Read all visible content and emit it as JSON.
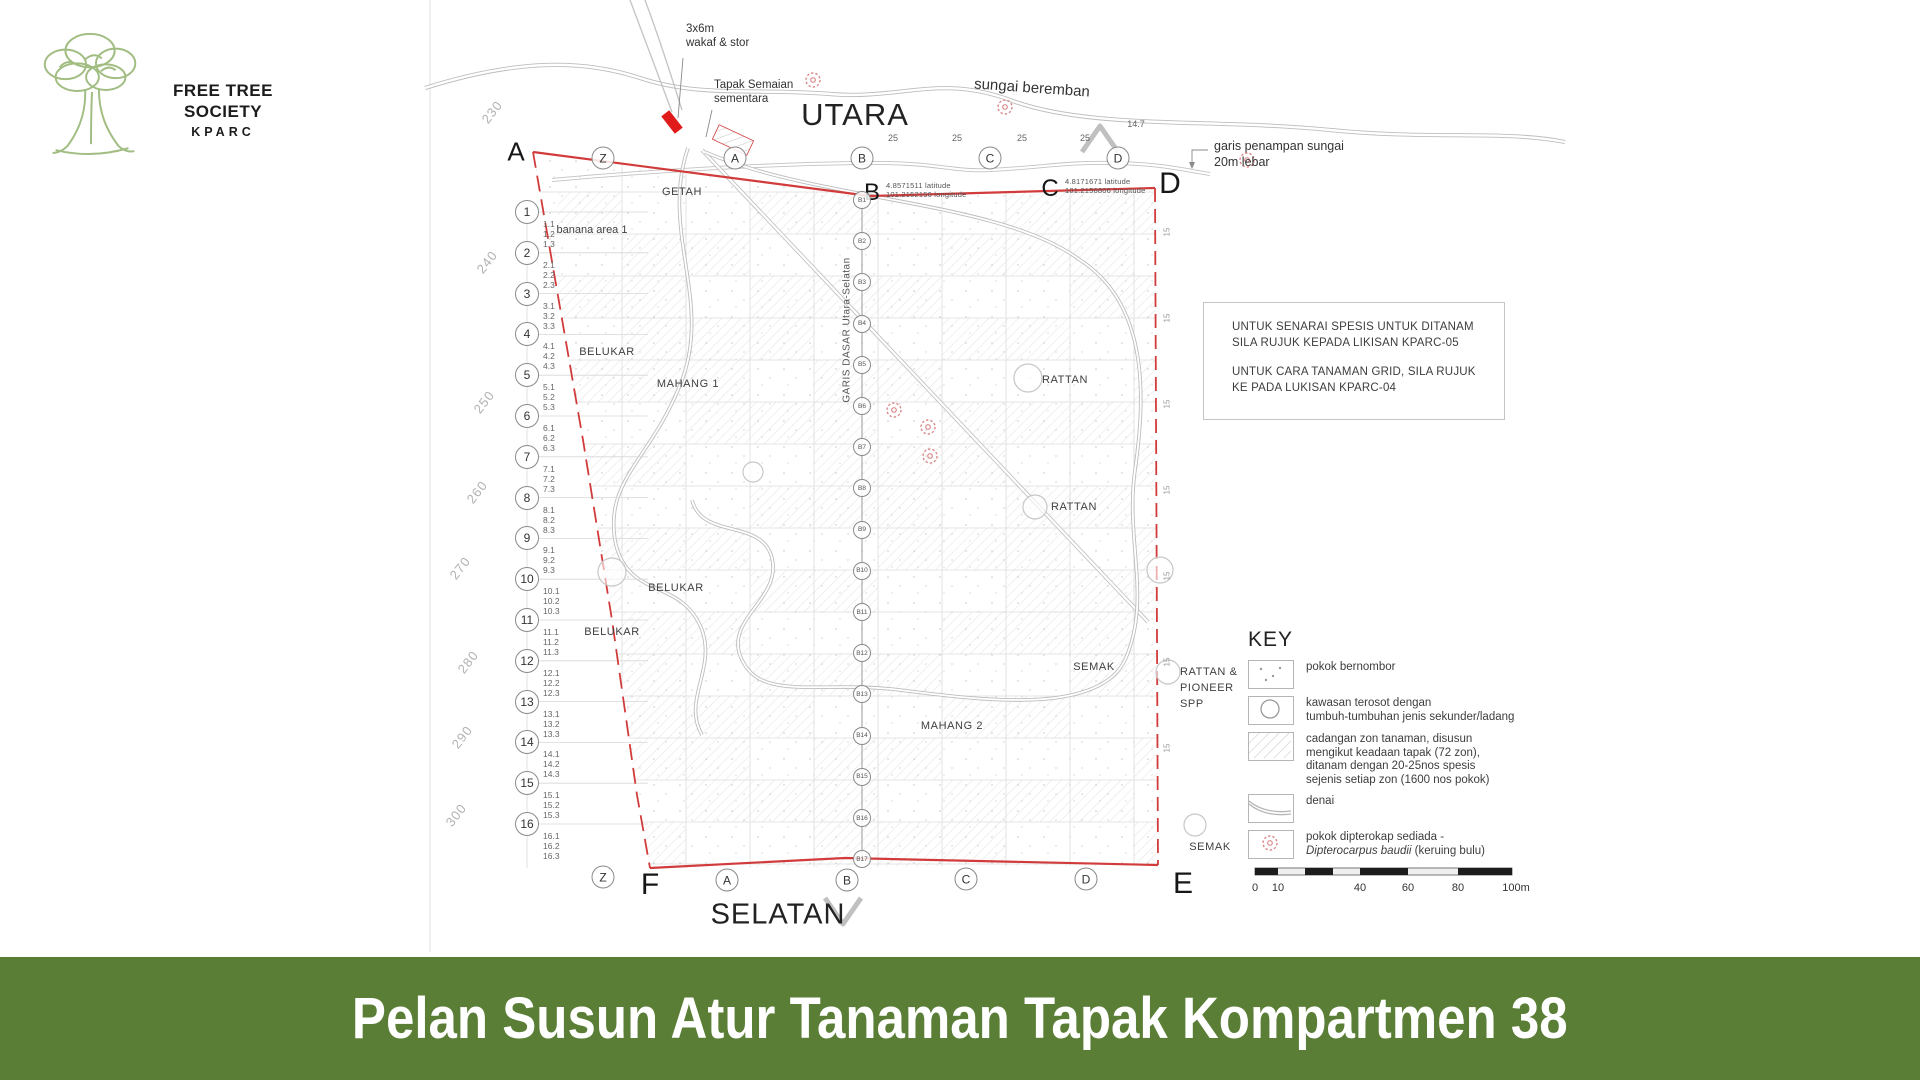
{
  "logo": {
    "org": [
      "FREE TREE",
      "SOCIETY"
    ],
    "site": "KPARC"
  },
  "colors": {
    "footer_green": "#5a7e36",
    "boundary_red": "#d23b3b",
    "logo_green": "#9cba7c",
    "wakaf_red": "#e01b1b"
  },
  "compass": {
    "north": "UTARA",
    "south": "SELATAN"
  },
  "river_label": "sungai beremban",
  "annotations": {
    "wakaf_line1": "3x6m",
    "wakaf_line2": "wakaf & stor",
    "semaian_line1": "Tapak Semaian",
    "semaian_line2": "sementara",
    "buffer_line1": "garis penampan sungai",
    "buffer_line2": "20m lebar"
  },
  "survey_points": {
    "B": {
      "letter": "B",
      "lat": "4.8571511  latitude",
      "lng": "101.2152156  longitude"
    },
    "C": {
      "letter": "C",
      "lat": "4.8171671  latitude",
      "lng": "101.2156806  longitude"
    }
  },
  "corner_letters": {
    "top_left": "A",
    "top_right": "D",
    "bottom_left": "F",
    "bottom_right": "E"
  },
  "grid_letters_top": [
    "Z",
    "A",
    "B",
    "C",
    "D"
  ],
  "grid_letters_bottom": [
    "Z",
    "A",
    "B",
    "C",
    "D"
  ],
  "top_distances": [
    "25",
    "25",
    "25",
    "25"
  ],
  "top_distance_end": "14.7",
  "right_tick_value": "15",
  "contour_labels": [
    "230",
    "240",
    "250",
    "260",
    "270",
    "280",
    "290",
    "300"
  ],
  "row_numbers": [
    {
      "n": "1",
      "subs": [
        "1.1",
        "1.2",
        "1.3"
      ]
    },
    {
      "n": "2",
      "subs": [
        "2.1",
        "2.2",
        "2.3"
      ]
    },
    {
      "n": "3",
      "subs": [
        "3.1",
        "3.2",
        "3.3"
      ]
    },
    {
      "n": "4",
      "subs": [
        "4.1",
        "4.2",
        "4.3"
      ]
    },
    {
      "n": "5",
      "subs": [
        "5.1",
        "5.2",
        "5.3"
      ]
    },
    {
      "n": "6",
      "subs": [
        "6.1",
        "6.2",
        "6.3"
      ]
    },
    {
      "n": "7",
      "subs": [
        "7.1",
        "7.2",
        "7.3"
      ]
    },
    {
      "n": "8",
      "subs": [
        "8.1",
        "8.2",
        "8.3"
      ]
    },
    {
      "n": "9",
      "subs": [
        "9.1",
        "9.2",
        "9.3"
      ]
    },
    {
      "n": "10",
      "subs": [
        "10.1",
        "10.2",
        "10.3"
      ]
    },
    {
      "n": "11",
      "subs": [
        "11.1",
        "11.2",
        "11.3"
      ]
    },
    {
      "n": "12",
      "subs": [
        "12.1",
        "12.2",
        "12.3"
      ]
    },
    {
      "n": "13",
      "subs": [
        "13.1",
        "13.2",
        "13.3"
      ]
    },
    {
      "n": "14",
      "subs": [
        "14.1",
        "14.2",
        "14.3"
      ]
    },
    {
      "n": "15",
      "subs": [
        "15.1",
        "15.2",
        "15.3"
      ]
    },
    {
      "n": "16",
      "subs": [
        "16.1",
        "16.2",
        "16.3"
      ]
    }
  ],
  "baseline": {
    "label": "GARIS DASAR Utara-Selatan",
    "markers": [
      "B1",
      "B2",
      "B3",
      "B4",
      "B5",
      "B6",
      "B7",
      "B8",
      "B9",
      "B10",
      "B11",
      "B12",
      "B13",
      "B14",
      "B15",
      "B16",
      "B17"
    ]
  },
  "region_labels": [
    "GETAH",
    "banana area 1",
    "BELUKAR",
    "MAHANG 1",
    "RATTAN",
    "RATTAN",
    "BELUKAR",
    "BELUKAR",
    "SEMAK",
    "MAHANG 2",
    "SEMAK"
  ],
  "rattan_pioneer": [
    "RATTAN &",
    "PIONEER",
    "SPP"
  ],
  "notes": {
    "l1": "UNTUK SENARAI SPESIS UNTUK DITANAM",
    "l2": "SILA RUJUK KEPADA LIKISAN KPARC-05",
    "l3": "UNTUK CARA TANAMAN GRID, SILA RUJUK",
    "l4": "KE PADA LUKISAN KPARC-04"
  },
  "key": {
    "title": "KEY",
    "items": [
      {
        "symbol": "dots",
        "lines": [
          "pokok bernombor"
        ]
      },
      {
        "symbol": "circle",
        "lines": [
          "kawasan terosot  dengan",
          "tumbuh-tumbuhan jenis sekunder/ladang"
        ]
      },
      {
        "symbol": "hatch",
        "lines": [
          "cadangan zon tanaman, disusun",
          "mengikut keadaan tapak (72 zon),",
          "ditanam  dengan 20-25nos spesis",
          "sejenis setiap zon (1600 nos pokok)"
        ]
      },
      {
        "symbol": "trail",
        "lines": [
          "denai"
        ]
      },
      {
        "symbol": "flower",
        "lines": [
          "pokok dipterokap sediada -",
          "Dipterocarpus baudii (keruing bulu)"
        ],
        "italic_line": 1
      }
    ]
  },
  "scale_bar": {
    "ticks": [
      "0",
      "10",
      "40",
      "60",
      "80",
      "100m"
    ]
  },
  "footer": {
    "title": "Pelan Susun Atur Tanaman Tapak Kompartmen 38"
  }
}
